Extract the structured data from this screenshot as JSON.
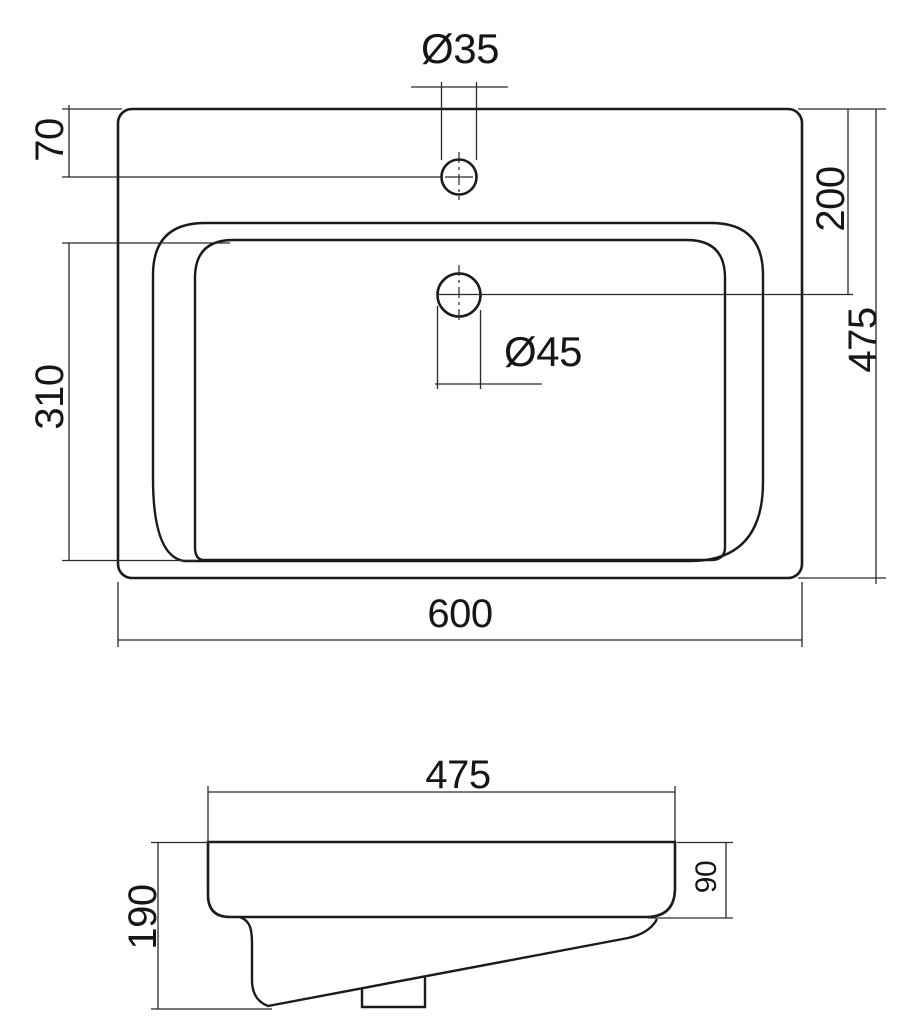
{
  "drawing": {
    "type": "washbasin-dimension-drawing",
    "line_color": "#1b1b1b",
    "background": "#ffffff"
  },
  "top_view": {
    "faucet_hole_label": "Ø35",
    "drain_hole_label": "Ø45",
    "dim_rim_to_faucet": "70",
    "dim_basin_depth": "310",
    "dim_faucet_to_drain": "200",
    "dim_overall_depth": "475",
    "dim_overall_width": "600"
  },
  "side_view": {
    "dim_basin_width": "475",
    "dim_total_height": "190",
    "dim_rim_height": "90"
  }
}
